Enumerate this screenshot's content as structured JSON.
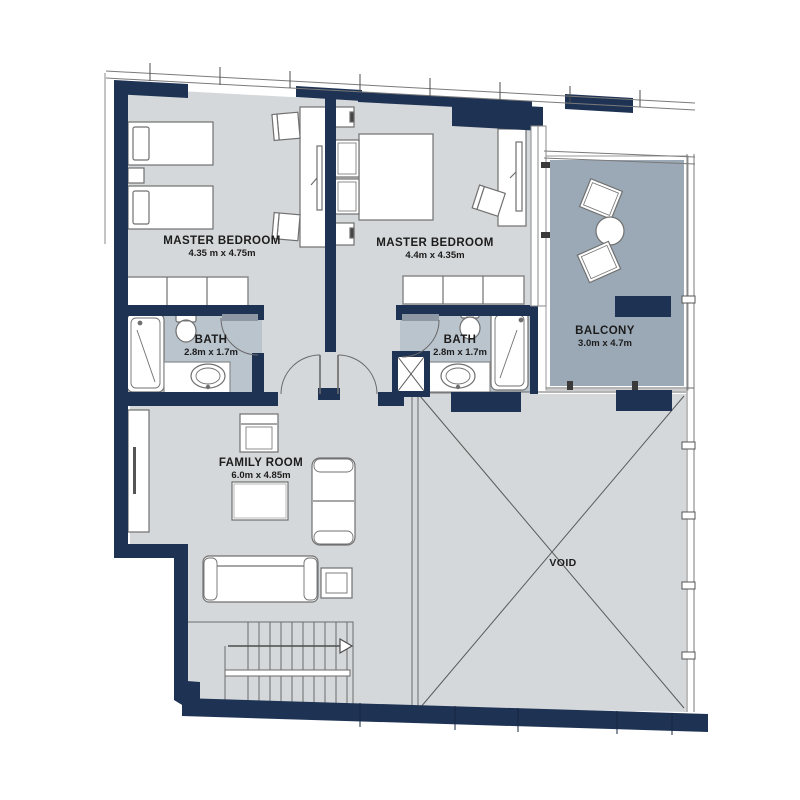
{
  "plan": {
    "type": "residential floor plan",
    "rooms": [
      {
        "name": "MASTER BEDROOM",
        "dims": "4.35 m x 4.75m"
      },
      {
        "name": "MASTER BEDROOM",
        "dims": "4.4m x 4.35m"
      },
      {
        "name": "BATH",
        "dims": "2.8m x 1.7m"
      },
      {
        "name": "BATH",
        "dims": "2.8m x 1.7m"
      },
      {
        "name": "BALCONY",
        "dims": "3.0m x 4.7m"
      },
      {
        "name": "FAMILY ROOM",
        "dims": "6.0m x 4.85m"
      },
      {
        "name": "VOID",
        "dims": ""
      }
    ],
    "colors": {
      "wall_navy": "#1e3354",
      "room_fill": "#d5d8da",
      "bath_fill": "#bac4cd",
      "balcony_fill": "#9aa9b5",
      "line": "#5a5a5a",
      "background": "#ffffff"
    }
  }
}
